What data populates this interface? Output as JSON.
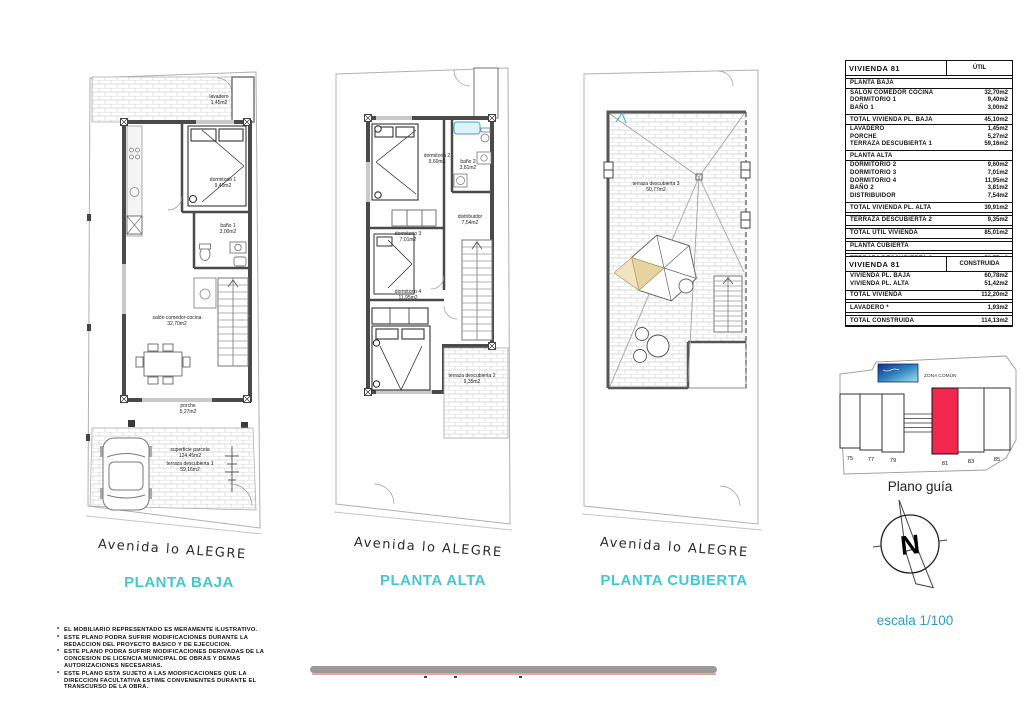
{
  "plans": {
    "baja": {
      "title": "PLANTA BAJA",
      "street": "Avenida lo ALEGRE",
      "rooms": [
        {
          "name": "lavadero",
          "area": "1,45m2"
        },
        {
          "name": "dormitorio 1",
          "area": "9,40m2"
        },
        {
          "name": "baño 1",
          "area": "3,00m2"
        },
        {
          "name": "salón comedor-cocina",
          "area": "32,70m2"
        },
        {
          "name": "porche",
          "area": "5,27m2"
        },
        {
          "name": "superficie parcela",
          "area": "124,45m2"
        },
        {
          "name": "terraza descubierta 1",
          "area": "59,16m2"
        }
      ]
    },
    "alta": {
      "title": "PLANTA ALTA",
      "street": "Avenida lo ALEGRE",
      "rooms": [
        {
          "name": "dormitorio 2",
          "area": "9,60m2"
        },
        {
          "name": "baño 2",
          "area": "3,81m2"
        },
        {
          "name": "dormitorio 3",
          "area": "7,01m2"
        },
        {
          "name": "distribuidor",
          "area": "7,54m2"
        },
        {
          "name": "dormitorio 4",
          "area": "11,95m2"
        },
        {
          "name": "terraza descubierta 2",
          "area": "9,35m2"
        }
      ]
    },
    "cubierta": {
      "title": "PLANTA CUBIERTA",
      "street": "Avenida lo ALEGRE",
      "rooms": [
        {
          "name": "terraza descubierta 3",
          "area": "50,77m2"
        }
      ]
    }
  },
  "tables": {
    "util": {
      "title": "VIVIENDA 81",
      "col": "ÚTIL",
      "rows": [
        {
          "t": "section",
          "label": "PLANTA BAJA"
        },
        {
          "t": "item",
          "label": "SALÓN COMEDOR COCINA",
          "value": "32,70m2"
        },
        {
          "t": "item",
          "label": "DORMITORIO 1",
          "value": "9,40m2"
        },
        {
          "t": "item",
          "label": "BAÑO 1",
          "value": "3,00m2"
        },
        {
          "t": "total",
          "label": "TOTAL VIVIENDA PL. BAJA",
          "value": "45,10m2"
        },
        {
          "t": "item",
          "label": "LAVADERO",
          "value": "1,45m2"
        },
        {
          "t": "item",
          "label": "PORCHE",
          "value": "5,27m2"
        },
        {
          "t": "item",
          "label": "TERRAZA DESCUBIERTA 1",
          "value": "59,16m2"
        },
        {
          "t": "section",
          "label": "PLANTA ALTA"
        },
        {
          "t": "item",
          "label": "DORMITORIO 2",
          "value": "9,60m2"
        },
        {
          "t": "item",
          "label": "DORMITORIO 3",
          "value": "7,01m2"
        },
        {
          "t": "item",
          "label": "DORMITORIO 4",
          "value": "11,95m2"
        },
        {
          "t": "item",
          "label": "BAÑO 2",
          "value": "3,81m2"
        },
        {
          "t": "item",
          "label": "DISTRIBUIDOR",
          "value": "7,54m2"
        },
        {
          "t": "total",
          "label": "TOTAL VIVIENDA PL. ALTA",
          "value": "39,91m2"
        },
        {
          "t": "total",
          "label": "TERRAZA DESCUBIERTA 2",
          "value": "9,35m2"
        },
        {
          "t": "total",
          "label": "TOTAL ÚTIL VIVIENDA",
          "value": "85,01m2"
        },
        {
          "t": "section",
          "label": "PLANTA CUBIERTA"
        },
        {
          "t": "total",
          "label": "TERRAZA DESCUBIERTA 3",
          "value": "50,77m2"
        },
        {
          "t": "total",
          "label": "PARCELA",
          "value": "124,45m2"
        }
      ]
    },
    "construida": {
      "title": "VIVIENDA 81",
      "col": "CONSTRUIDA",
      "rows": [
        {
          "t": "item",
          "label": "VIVIENDA PL. BAJA",
          "value": "60,78m2"
        },
        {
          "t": "item",
          "label": "VIVIENDA PL. ALTA",
          "value": "51,42m2"
        },
        {
          "t": "total",
          "label": "TOTAL VIVIENDA",
          "value": "112,20m2"
        },
        {
          "t": "total",
          "label": "LAVADERO *",
          "value": "1,93m2"
        },
        {
          "t": "total",
          "label": "TOTAL CONSTRUIDA",
          "value": "114,13m2"
        }
      ]
    }
  },
  "plano_guia": {
    "label": "Plano guía",
    "zona_comun": "ZONA COMÚN",
    "plots": [
      "75",
      "77",
      "79",
      "81",
      "83",
      "85"
    ],
    "highlighted_plot": "81"
  },
  "compass": {
    "letter": "N"
  },
  "scale": {
    "label": "escala 1/100"
  },
  "disclaimer": {
    "bullet": "*",
    "items": [
      "EL MOBILIARIO REPRESENTADO ES MERAMENTE ILUSTRATIVO.",
      "ESTE PLANO PODRA SUFRIR MODIFICACIONES DURANTE LA REDACCION DEL PROYECTO BASICO Y DE EJECUCION.",
      "ESTE PLANO PODRA SUFRIR MODIFICACIONES DERIVADAS DE LA CONCESION DE LICENCIA MUNICIPAL DE OBRAS Y DEMAS AUTORIZACIONES NECESARIAS.",
      "ESTE PLANO ESTA SUJETO A LAS MODIFICACIONES QUE LA DIRECCION FACULTATIVA ESTIME CONVENIENTES DURANTE EL TRANSCURSO DE LA OBRA."
    ]
  },
  "colors": {
    "accent_cyan": "#45C7D1",
    "scale_blue": "#2B9EC6",
    "plot_red": "#F2274E",
    "pool_dark": "#14307E",
    "pool_light": "#9FE6EC",
    "bar_gray": "#9C9998",
    "bar_salmon": "#DFA8A0"
  }
}
